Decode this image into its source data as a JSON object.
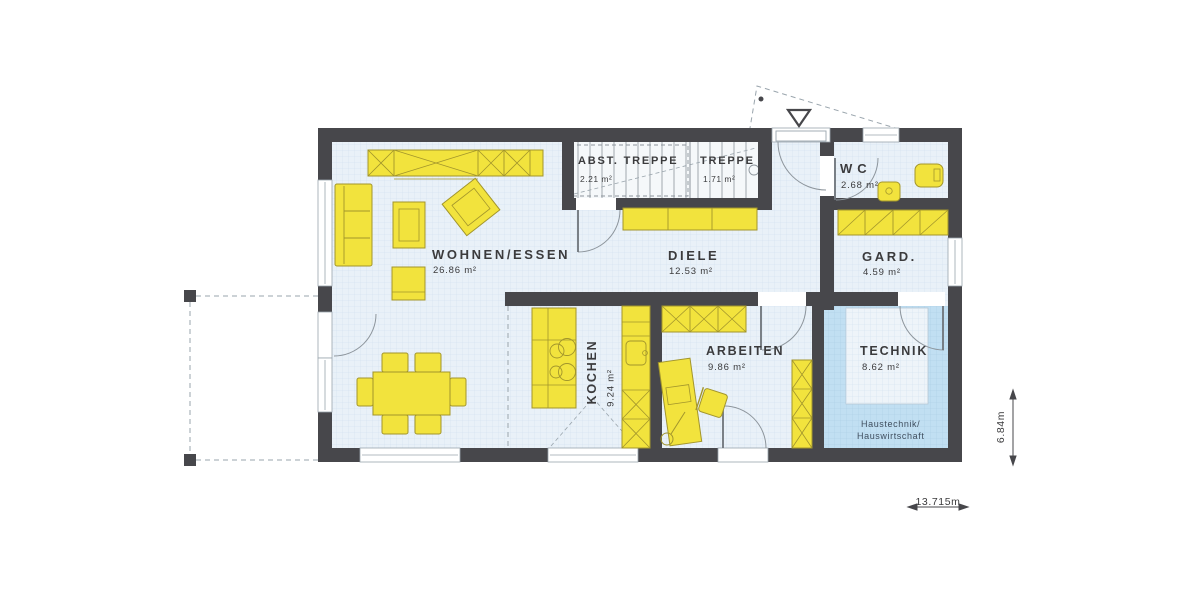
{
  "plan": {
    "type": "ground-floor-plan",
    "rooms": {
      "wohnen_essen": {
        "label": "WOHNEN/ESSEN",
        "area": "26.86 m²"
      },
      "abstellraum": {
        "label": "ABST. TREPPE",
        "area": "2.21 m²"
      },
      "treppe": {
        "label": "TREPPE",
        "area": "1.71 m²"
      },
      "diele": {
        "label": "DIELE",
        "area": "12.53 m²"
      },
      "wc": {
        "label": "WC",
        "area": "2.68 m²"
      },
      "garderobe": {
        "label": "GARD.",
        "area": "4.59 m²"
      },
      "kochen": {
        "label": "KOCHEN",
        "area": "9.24 m²"
      },
      "arbeiten": {
        "label": "ARBEITEN",
        "area": "9.86 m²"
      },
      "technik": {
        "label": "TECHNIK",
        "area": "8.62 m²",
        "note_line1": "Haustechnik/",
        "note_line2": "Hauswirtschaft"
      }
    },
    "dimensions": {
      "total_width": "13.715m",
      "total_height": "6.84m"
    },
    "colors": {
      "wall": "#47474b",
      "furniture": "#f2e33d",
      "furniture_outline": "#a2952c",
      "floor": "#e9f1f8",
      "floor_technik": "#c1dff2",
      "text": "#3b3b3d"
    }
  }
}
